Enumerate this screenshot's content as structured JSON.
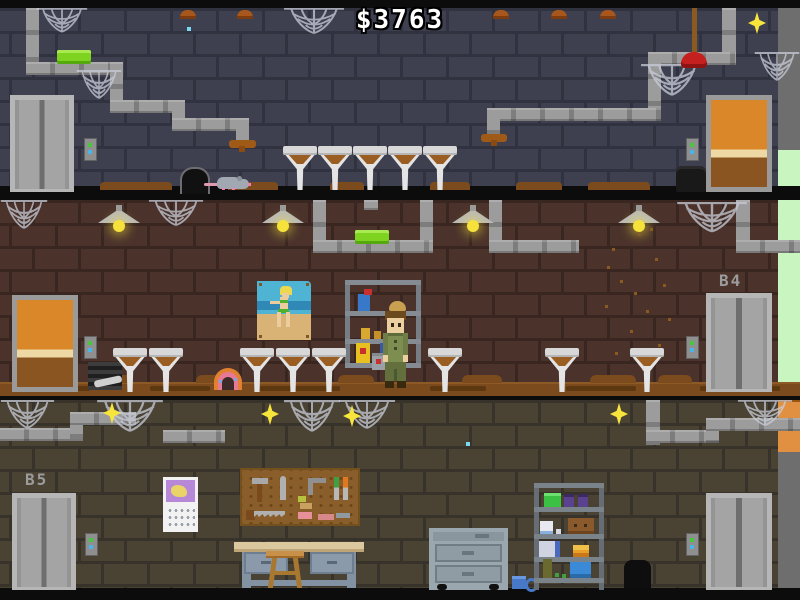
{
  "hud": {
    "money_counter": "$3763"
  },
  "floor_labels": {
    "middle_right_elevator": "B4",
    "bottom_left_elevator": "B5"
  },
  "palette": {
    "top_wall_brick": "#3e4050",
    "top_wall_mortar": "#313240",
    "mid_wall_brick": "#4b332c",
    "mid_wall_mortar": "#392621",
    "bottom_wall_brick": "#4a4334",
    "bottom_wall_mortar": "#37322a",
    "pipe_gray": "#9c9c9c",
    "elevator_gray": "#b6b6b6",
    "door_orange": "#d98728",
    "soap_green": "#7ed321",
    "bulb_yellow": "#f8e53c",
    "dirt_brown": "#7b4a1d",
    "money_text": "#ffffff",
    "label_gray": "#9b9b9b",
    "edge_green": "#c9f6c0",
    "edge_orange": "#e09040",
    "edge_gray": "#6e6e6e"
  },
  "scene": {
    "floors": [
      {
        "name": "top basement",
        "label": "",
        "wall": "blue-gray brick",
        "objects": [
          "elevator",
          "wooden-door",
          "5 dirty toilets",
          "rat",
          "mouse-hole",
          "plunger",
          "bucket",
          "pipes",
          "cobwebs",
          "green soap bar",
          "glowing bulb",
          "call buttons",
          "money counter"
        ]
      },
      {
        "name": "middle basement",
        "label": "B4",
        "wall": "brown brick",
        "objects": [
          "elevator",
          "wooden-door",
          "8 dirty toilets",
          "pinup poster",
          "supply shelf",
          "toolbox",
          "janitor character",
          "4 ceiling lamps",
          "pipes",
          "cobwebs",
          "green soap bar",
          "rainbow toy",
          "vent",
          "fly specks",
          "call buttons"
        ]
      },
      {
        "name": "bottom basement",
        "label": "B5",
        "wall": "olive brick",
        "objects": [
          "2 elevators",
          "calendar",
          "pegboard with tools",
          "workbench",
          "stool",
          "rolling cabinet",
          "mug",
          "storage shelf",
          "bucket",
          "pipes",
          "cobwebs",
          "4 glowing bulbs",
          "call buttons"
        ]
      }
    ]
  }
}
